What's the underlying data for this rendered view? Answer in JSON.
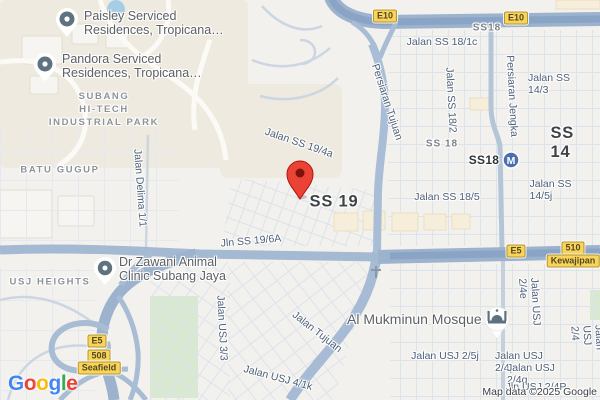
{
  "map": {
    "attribution": "Map data ©2025 Google",
    "brand": {
      "letters": [
        {
          "ch": "G",
          "color": "#4285F4"
        },
        {
          "ch": "o",
          "color": "#EA4335"
        },
        {
          "ch": "o",
          "color": "#FBBC05"
        },
        {
          "ch": "g",
          "color": "#4285F4"
        },
        {
          "ch": "l",
          "color": "#34A853"
        },
        {
          "ch": "e",
          "color": "#EA4335"
        }
      ]
    },
    "station": {
      "name_label": "SS18",
      "glyph": "M"
    },
    "colors": {
      "marker_red": "#EA4335",
      "badge_yellow": "#F9D45C",
      "highway_fill": "#9CB2CD",
      "road_fill": "#A9BED6",
      "station_blue": "#4A6FAE",
      "park_green": "#D8E8D1",
      "water_blue": "#A6CDE6",
      "land_beige": "#EEEADF"
    }
  },
  "labels": [
    {
      "name": "poi-label-paisley",
      "cls": "poi",
      "text": "Paisley Serviced\nResidences, Tropicana…",
      "x": 84,
      "y": 9,
      "anchor": "tl",
      "click": true
    },
    {
      "name": "poi-label-pandora",
      "cls": "poi",
      "text": "Pandora Serviced\nResidences, Tropicana…",
      "x": 62,
      "y": 52,
      "anchor": "tl",
      "click": true
    },
    {
      "name": "poi-label-dr-zawani",
      "cls": "poi",
      "text": "Dr Zawani Animal\nClinic Subang Jaya",
      "x": 119,
      "y": 255,
      "anchor": "tl",
      "click": true
    },
    {
      "name": "poi-label-mosque",
      "cls": "poi-lg",
      "text": "Al Mukminun Mosque",
      "x": 347,
      "y": 311,
      "anchor": "tl",
      "click": true
    },
    {
      "name": "area-label-subang-hitech",
      "cls": "area",
      "text": "SUBANG\nHI-TECH\nINDUSTRIAL PARK",
      "x": 104,
      "y": 110
    },
    {
      "name": "area-label-batu-gugup",
      "cls": "area",
      "text": "BATU GUGUP",
      "x": 60,
      "y": 171
    },
    {
      "name": "area-label-usj-heights",
      "cls": "area",
      "text": "USJ HEIGHTS",
      "x": 50,
      "y": 283
    },
    {
      "name": "district-label-ss19",
      "cls": "district",
      "text": "SS 19",
      "x": 334,
      "y": 202
    },
    {
      "name": "district-label-ss14",
      "cls": "district",
      "text": "SS 14",
      "x": 567,
      "y": 143
    },
    {
      "name": "district-label-ss18-top",
      "cls": "area-sm",
      "text": "SS18",
      "x": 487,
      "y": 28
    },
    {
      "name": "district-label-ss18-mid",
      "cls": "area-sm",
      "text": "SS 18",
      "x": 442,
      "y": 144
    },
    {
      "name": "station-label-ss18",
      "cls": "station",
      "text": "SS18",
      "x": 484,
      "y": 160,
      "click": true
    },
    {
      "name": "road-label-jalan-delima-1-1",
      "cls": "road",
      "text": "Jalan Delima 1/1",
      "x": 140,
      "y": 188,
      "rot": 86
    },
    {
      "name": "road-label-jalan-ss-19-4a",
      "cls": "road",
      "text": "Jalan SS 19/4a",
      "x": 299,
      "y": 143,
      "rot": 19
    },
    {
      "name": "road-label-jln-ss-19-6a",
      "cls": "road",
      "text": "Jln SS 19/6A",
      "x": 251,
      "y": 241,
      "rot": -5
    },
    {
      "name": "road-label-persiaran-tujuan",
      "cls": "road",
      "text": "Persiaran Tujuan",
      "x": 387,
      "y": 102,
      "rot": 72
    },
    {
      "name": "road-label-jalan-ss-18-1c",
      "cls": "road",
      "text": "Jalan SS 18/1c",
      "x": 442,
      "y": 42
    },
    {
      "name": "road-label-jalan-ss-18-2",
      "cls": "road",
      "text": "Jalan SS 18/2",
      "x": 451,
      "y": 100,
      "rot": 87
    },
    {
      "name": "road-label-persiaran-jengka",
      "cls": "road",
      "text": "Persiaran Jengka",
      "x": 512,
      "y": 96,
      "rot": 87
    },
    {
      "name": "road-label-jalan-ss-14-3",
      "cls": "road",
      "text": "Jalan SS 14/3",
      "x": 552,
      "y": 84
    },
    {
      "name": "road-label-jalan-ss-18-5",
      "cls": "road",
      "text": "Jalan SS 18/5",
      "x": 447,
      "y": 197
    },
    {
      "name": "road-label-jalan-ss-14-5j",
      "cls": "road",
      "text": "Jalan SS 14/5j",
      "x": 553,
      "y": 190
    },
    {
      "name": "road-label-jalan-usj-3-3",
      "cls": "road",
      "text": "Jalan USJ 3/3",
      "x": 222,
      "y": 328,
      "rot": 87
    },
    {
      "name": "road-label-jalan-usj-2-5j",
      "cls": "road",
      "text": "Jalan USJ 2/5j",
      "x": 445,
      "y": 356
    },
    {
      "name": "road-label-jalan-tujuan",
      "cls": "road",
      "text": "Jalan Tujuan",
      "x": 317,
      "y": 332,
      "rot": 38
    },
    {
      "name": "road-label-jalan-usj-4-1k",
      "cls": "road",
      "text": "Jalan USJ 4/1k",
      "x": 278,
      "y": 378,
      "rot": 15
    },
    {
      "name": "road-label-jalan-usj-2-4e",
      "cls": "road",
      "text": "Jalan USJ 2/4e",
      "x": 530,
      "y": 313,
      "rot": 87
    },
    {
      "name": "road-label-jalan-usj-2-4",
      "cls": "road",
      "text": "Jalan USJ 2/4",
      "x": 587,
      "y": 338,
      "rot": 87
    },
    {
      "name": "road-label-jalan-usj-2-4p",
      "cls": "road",
      "text": "Jalan USJ 2/4p",
      "x": 530,
      "y": 362
    },
    {
      "name": "road-label-jalan-usj-2-4q",
      "cls": "road",
      "text": "Jalan USJ 2/4q",
      "x": 538,
      "y": 374
    },
    {
      "name": "road-label-jln-usj-2-4p",
      "cls": "road",
      "text": "Jln USJ 2/4P",
      "x": 536,
      "y": 387
    }
  ],
  "badges": [
    {
      "name": "route-badge-e10-west",
      "text": "E10",
      "x": 385,
      "y": 16
    },
    {
      "name": "route-badge-e10-east",
      "text": "E10",
      "x": 516,
      "y": 18
    },
    {
      "name": "route-badge-e5-seafield",
      "text": "E5",
      "x": 97,
      "y": 341
    },
    {
      "name": "route-badge-508",
      "text": "508",
      "x": 99,
      "y": 356
    },
    {
      "name": "exit-badge-seafield",
      "text": "Seafield",
      "x": 99,
      "y": 368
    },
    {
      "name": "route-badge-e5-kewajipan",
      "text": "E5",
      "x": 516,
      "y": 251
    },
    {
      "name": "route-badge-510",
      "text": "510",
      "x": 573,
      "y": 248
    },
    {
      "name": "exit-badge-kewajipan",
      "text": "Kewajipan",
      "x": 573,
      "y": 261
    }
  ]
}
